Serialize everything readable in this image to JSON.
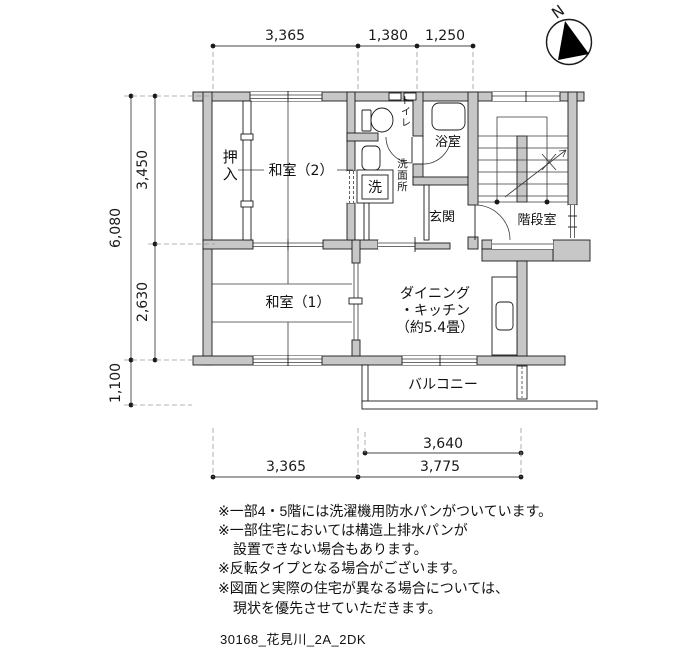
{
  "title": "間取り図（2DK）",
  "colors": {
    "wall_fill": "#c7c7c7",
    "line": "#1a1a1a"
  },
  "compass": {
    "label": "N"
  },
  "dimensions": {
    "top": [
      "3,365",
      "1,380",
      "1,250"
    ],
    "left": {
      "total": "6,080",
      "upper": "3,450",
      "lower": "2,630",
      "balcony": "1,100"
    },
    "bottom": {
      "balcony": "3,640",
      "left": "3,365",
      "right": "3,775"
    }
  },
  "rooms": {
    "oshiire": "押入",
    "washitsu2": "和室（2）",
    "washitsu1": "和室（1）",
    "toilet": "トイレ",
    "bath": "浴室",
    "washroom": "洗面所",
    "laundry": "洗",
    "genkan": "玄関",
    "stairwell": "階段室",
    "dk1": "ダイニング",
    "dk2": "・キッチン",
    "dk3": "（約5.4畳）",
    "balcony": "バルコニー"
  },
  "notes": [
    "※一部4・5階には洗濯機用防水パンがついています。",
    "※一部住宅においては構造上排水パンが",
    "設置できない場合もあります。",
    "※反転タイプとなる場合がございます。",
    "※図面と実際の住宅が異なる場合については、",
    "現状を優先させていただきます。"
  ],
  "footer": "30168_花見川_2A_2DK"
}
